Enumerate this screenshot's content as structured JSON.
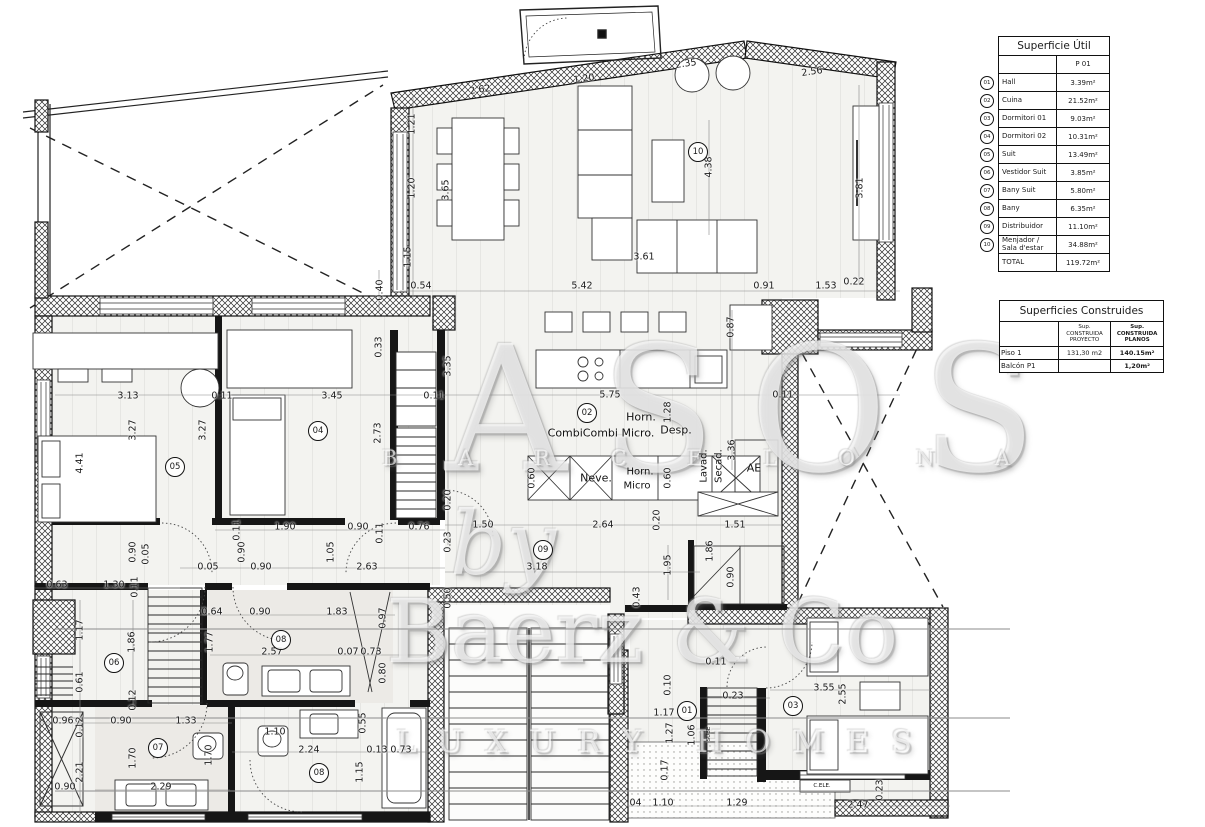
{
  "tables": {
    "superficie_util": {
      "title": "Superficie Útil",
      "col_header": "P 01",
      "rows": [
        {
          "num": "01",
          "label": "Hall",
          "value": "3.39m²"
        },
        {
          "num": "02",
          "label": "Cuina",
          "value": "21.52m²"
        },
        {
          "num": "03",
          "label": "Dormitori 01",
          "value": "9.03m²"
        },
        {
          "num": "04",
          "label": "Dormitori 02",
          "value": "10.31m²"
        },
        {
          "num": "05",
          "label": "Suit",
          "value": "13.49m²"
        },
        {
          "num": "06",
          "label": "Vestidor Suit",
          "value": "3.85m²"
        },
        {
          "num": "07",
          "label": "Bany Suit",
          "value": "5.80m²"
        },
        {
          "num": "08",
          "label": "Bany",
          "value": "6.35m²"
        },
        {
          "num": "09",
          "label": "Distribuidor",
          "value": "11.10m²"
        },
        {
          "num": "10",
          "label": "Menjador / Sala d'estar",
          "value": "34.88m²"
        }
      ],
      "total_label": "TOTAL",
      "total_value": "119.72m²"
    },
    "superficies_construides": {
      "title": "Superficies Construides",
      "col_proyecto": "Sup. CONSTRUIDA PROYECTO",
      "col_planos": "Sup. CONSTRUIDA PLANOS",
      "rows": [
        {
          "label": "Piso 1",
          "proyecto": "131,30 m2",
          "planos": "140.15m²"
        },
        {
          "label": "Balcón P1",
          "proyecto": "",
          "planos": "1,20m²"
        }
      ]
    }
  },
  "watermark": {
    "big": "ASOS",
    "city_line": "B A R C E L O N A",
    "by": "by",
    "brand": "Baerz & Co",
    "tagline": "LUXURY HOMES"
  },
  "plan": {
    "rooms": [
      {
        "n": "01",
        "x": 687,
        "y": 711
      },
      {
        "n": "02",
        "x": 587,
        "y": 413
      },
      {
        "n": "03",
        "x": 793,
        "y": 706
      },
      {
        "n": "04",
        "x": 318,
        "y": 431
      },
      {
        "n": "05",
        "x": 175,
        "y": 467
      },
      {
        "n": "06",
        "x": 114,
        "y": 663
      },
      {
        "n": "07",
        "x": 158,
        "y": 748
      },
      {
        "n": "08",
        "x": 281,
        "y": 640
      },
      {
        "n": "08",
        "x": 319,
        "y": 773
      },
      {
        "n": "09",
        "x": 543,
        "y": 550
      },
      {
        "n": "10",
        "x": 698,
        "y": 152
      }
    ],
    "labels": [
      {
        "t": "Horn.",
        "x": 641,
        "y": 417,
        "s": 11
      },
      {
        "t": "CombiCombi Micro.",
        "x": 601,
        "y": 433,
        "s": 11
      },
      {
        "t": "Desp.",
        "x": 676,
        "y": 430,
        "s": 11
      },
      {
        "t": "Neve.",
        "x": 596,
        "y": 478,
        "s": 11
      },
      {
        "t": "Horn.",
        "x": 640,
        "y": 472,
        "s": 10
      },
      {
        "t": "Micro",
        "x": 637,
        "y": 486,
        "s": 10
      },
      {
        "t": "Lavad.",
        "x": 704,
        "y": 466,
        "r": -90,
        "s": 10
      },
      {
        "t": "Secad.",
        "x": 719,
        "y": 466,
        "r": -90,
        "s": 10
      },
      {
        "t": "AE",
        "x": 754,
        "y": 468,
        "s": 11
      },
      {
        "t": "C.ELE.",
        "x": 822,
        "y": 786,
        "s": 5.5
      },
      {
        "t": "SUBE",
        "x": 709,
        "y": 734,
        "r": -90,
        "s": 5.5
      }
    ],
    "dims": [
      {
        "t": "2.62",
        "x": 480,
        "y": 90,
        "r": -8
      },
      {
        "t": "1.20",
        "x": 584,
        "y": 79,
        "r": -8
      },
      {
        "t": "2.35",
        "x": 686,
        "y": 64,
        "r": -8
      },
      {
        "t": "2.56",
        "x": 812,
        "y": 72,
        "r": -8
      },
      {
        "t": "1.21",
        "x": 412,
        "y": 124,
        "r": -90
      },
      {
        "t": "1.20",
        "x": 412,
        "y": 188,
        "r": -90
      },
      {
        "t": "1.15",
        "x": 408,
        "y": 257,
        "r": -90
      },
      {
        "t": "0.40",
        "x": 380,
        "y": 290,
        "r": -90
      },
      {
        "t": "0.54",
        "x": 421,
        "y": 286
      },
      {
        "t": "5.42",
        "x": 582,
        "y": 286
      },
      {
        "t": "0.91",
        "x": 764,
        "y": 286
      },
      {
        "t": "1.53",
        "x": 826,
        "y": 286
      },
      {
        "t": "0.22",
        "x": 854,
        "y": 282
      },
      {
        "t": "4.38",
        "x": 709,
        "y": 167,
        "r": -90
      },
      {
        "t": "3.61",
        "x": 644,
        "y": 257
      },
      {
        "t": "3.65",
        "x": 446,
        "y": 190,
        "r": -90
      },
      {
        "t": "3.81",
        "x": 860,
        "y": 188,
        "r": -90
      },
      {
        "t": "3.13",
        "x": 128,
        "y": 396
      },
      {
        "t": "0.11",
        "x": 222,
        "y": 396
      },
      {
        "t": "3.45",
        "x": 332,
        "y": 396
      },
      {
        "t": "0.11",
        "x": 434,
        "y": 396
      },
      {
        "t": "0.33",
        "x": 379,
        "y": 347,
        "r": -90
      },
      {
        "t": "3.35",
        "x": 448,
        "y": 366,
        "r": -90
      },
      {
        "t": "3.27",
        "x": 133,
        "y": 430,
        "r": -90
      },
      {
        "t": "3.27",
        "x": 203,
        "y": 430,
        "r": -90
      },
      {
        "t": "4.41",
        "x": 80,
        "y": 463,
        "r": -90
      },
      {
        "t": "2.73",
        "x": 378,
        "y": 433,
        "r": -90
      },
      {
        "t": "1.90",
        "x": 285,
        "y": 527
      },
      {
        "t": "0.90",
        "x": 358,
        "y": 527
      },
      {
        "t": "0.76",
        "x": 419,
        "y": 527
      },
      {
        "t": "0.11",
        "x": 237,
        "y": 530,
        "r": -90
      },
      {
        "t": "0.11",
        "x": 380,
        "y": 533,
        "r": -90
      },
      {
        "t": "0.90",
        "x": 242,
        "y": 552,
        "r": -90
      },
      {
        "t": "1.05",
        "x": 331,
        "y": 552,
        "r": -90
      },
      {
        "t": "0.90",
        "x": 133,
        "y": 552,
        "r": -90
      },
      {
        "t": "0.05",
        "x": 146,
        "y": 554,
        "r": -90
      },
      {
        "t": "0.05",
        "x": 208,
        "y": 567
      },
      {
        "t": "0.90",
        "x": 261,
        "y": 567
      },
      {
        "t": "2.63",
        "x": 367,
        "y": 567
      },
      {
        "t": "0.63",
        "x": 57,
        "y": 585
      },
      {
        "t": "1.30",
        "x": 114,
        "y": 585
      },
      {
        "t": "0.11",
        "x": 135,
        "y": 587,
        "r": -90
      },
      {
        "t": "0.87",
        "x": 731,
        "y": 327,
        "r": -90
      },
      {
        "t": "5.75",
        "x": 610,
        "y": 395
      },
      {
        "t": "0.11",
        "x": 783,
        "y": 395
      },
      {
        "t": "1.28",
        "x": 668,
        "y": 412,
        "r": -90
      },
      {
        "t": "0.60",
        "x": 532,
        "y": 478,
        "r": -90
      },
      {
        "t": "0.60",
        "x": 668,
        "y": 478,
        "r": -90
      },
      {
        "t": "3.36",
        "x": 732,
        "y": 450,
        "r": -90
      },
      {
        "t": "0.20",
        "x": 448,
        "y": 500,
        "r": -90
      },
      {
        "t": "1.50",
        "x": 483,
        "y": 525
      },
      {
        "t": "2.64",
        "x": 603,
        "y": 525
      },
      {
        "t": "0.20",
        "x": 657,
        "y": 520,
        "r": -90
      },
      {
        "t": "1.51",
        "x": 735,
        "y": 525
      },
      {
        "t": "0.23",
        "x": 448,
        "y": 542,
        "r": -90
      },
      {
        "t": "3.18",
        "x": 537,
        "y": 567
      },
      {
        "t": "1.95",
        "x": 668,
        "y": 565,
        "r": -90
      },
      {
        "t": "1.86",
        "x": 710,
        "y": 551,
        "r": -90
      },
      {
        "t": "0.90",
        "x": 731,
        "y": 577,
        "r": -90
      },
      {
        "t": "0.50",
        "x": 448,
        "y": 598,
        "r": -90
      },
      {
        "t": "0.43",
        "x": 637,
        "y": 597,
        "r": -90
      },
      {
        "t": "1.17",
        "x": 80,
        "y": 630,
        "r": -90
      },
      {
        "t": "1.86",
        "x": 132,
        "y": 642,
        "r": -90
      },
      {
        "t": "0.61",
        "x": 80,
        "y": 682,
        "r": -90
      },
      {
        "t": "0.12",
        "x": 133,
        "y": 700,
        "r": -90
      },
      {
        "t": "0.64",
        "x": 212,
        "y": 612
      },
      {
        "t": "0.90",
        "x": 260,
        "y": 612
      },
      {
        "t": "1.83",
        "x": 337,
        "y": 612
      },
      {
        "t": "0.97",
        "x": 383,
        "y": 618,
        "r": -90
      },
      {
        "t": "1.77",
        "x": 210,
        "y": 642,
        "r": -90
      },
      {
        "t": "2.57",
        "x": 272,
        "y": 652
      },
      {
        "t": "0.07",
        "x": 348,
        "y": 652
      },
      {
        "t": "0.73",
        "x": 371,
        "y": 652
      },
      {
        "t": "0.80",
        "x": 383,
        "y": 673,
        "r": -90
      },
      {
        "t": "0.96",
        "x": 63,
        "y": 721
      },
      {
        "t": "0.12",
        "x": 80,
        "y": 727,
        "r": -90
      },
      {
        "t": "0.90",
        "x": 121,
        "y": 721
      },
      {
        "t": "1.33",
        "x": 186,
        "y": 721
      },
      {
        "t": "1.70",
        "x": 133,
        "y": 758,
        "r": -90
      },
      {
        "t": "1.70",
        "x": 209,
        "y": 755,
        "r": -90
      },
      {
        "t": "2.21",
        "x": 80,
        "y": 772,
        "r": -90
      },
      {
        "t": "0.90",
        "x": 65,
        "y": 787
      },
      {
        "t": "2.29",
        "x": 161,
        "y": 787
      },
      {
        "t": "1.10",
        "x": 275,
        "y": 732
      },
      {
        "t": "2.24",
        "x": 309,
        "y": 750
      },
      {
        "t": "0.13",
        "x": 377,
        "y": 750
      },
      {
        "t": "0.73",
        "x": 401,
        "y": 750
      },
      {
        "t": "0.55",
        "x": 363,
        "y": 723,
        "r": -90
      },
      {
        "t": "1.15",
        "x": 360,
        "y": 772,
        "r": -90
      },
      {
        "t": "0.11",
        "x": 716,
        "y": 662
      },
      {
        "t": "0.10",
        "x": 668,
        "y": 685,
        "r": -90
      },
      {
        "t": "1.17",
        "x": 664,
        "y": 713
      },
      {
        "t": "1.27",
        "x": 670,
        "y": 733,
        "r": -90
      },
      {
        "t": "1.06",
        "x": 692,
        "y": 735,
        "r": -90
      },
      {
        "t": "0.17",
        "x": 665,
        "y": 770,
        "r": -90
      },
      {
        "t": "0.23",
        "x": 733,
        "y": 696
      },
      {
        "t": "3.55",
        "x": 824,
        "y": 688
      },
      {
        "t": "2.55",
        "x": 843,
        "y": 694,
        "r": -90
      },
      {
        "t": "0.23",
        "x": 880,
        "y": 790,
        "r": -90
      },
      {
        "t": "2.47",
        "x": 858,
        "y": 805
      },
      {
        "t": "1.29",
        "x": 737,
        "y": 803
      },
      {
        "t": "1.10",
        "x": 663,
        "y": 803
      },
      {
        "t": ".04",
        "x": 634,
        "y": 803
      }
    ]
  }
}
